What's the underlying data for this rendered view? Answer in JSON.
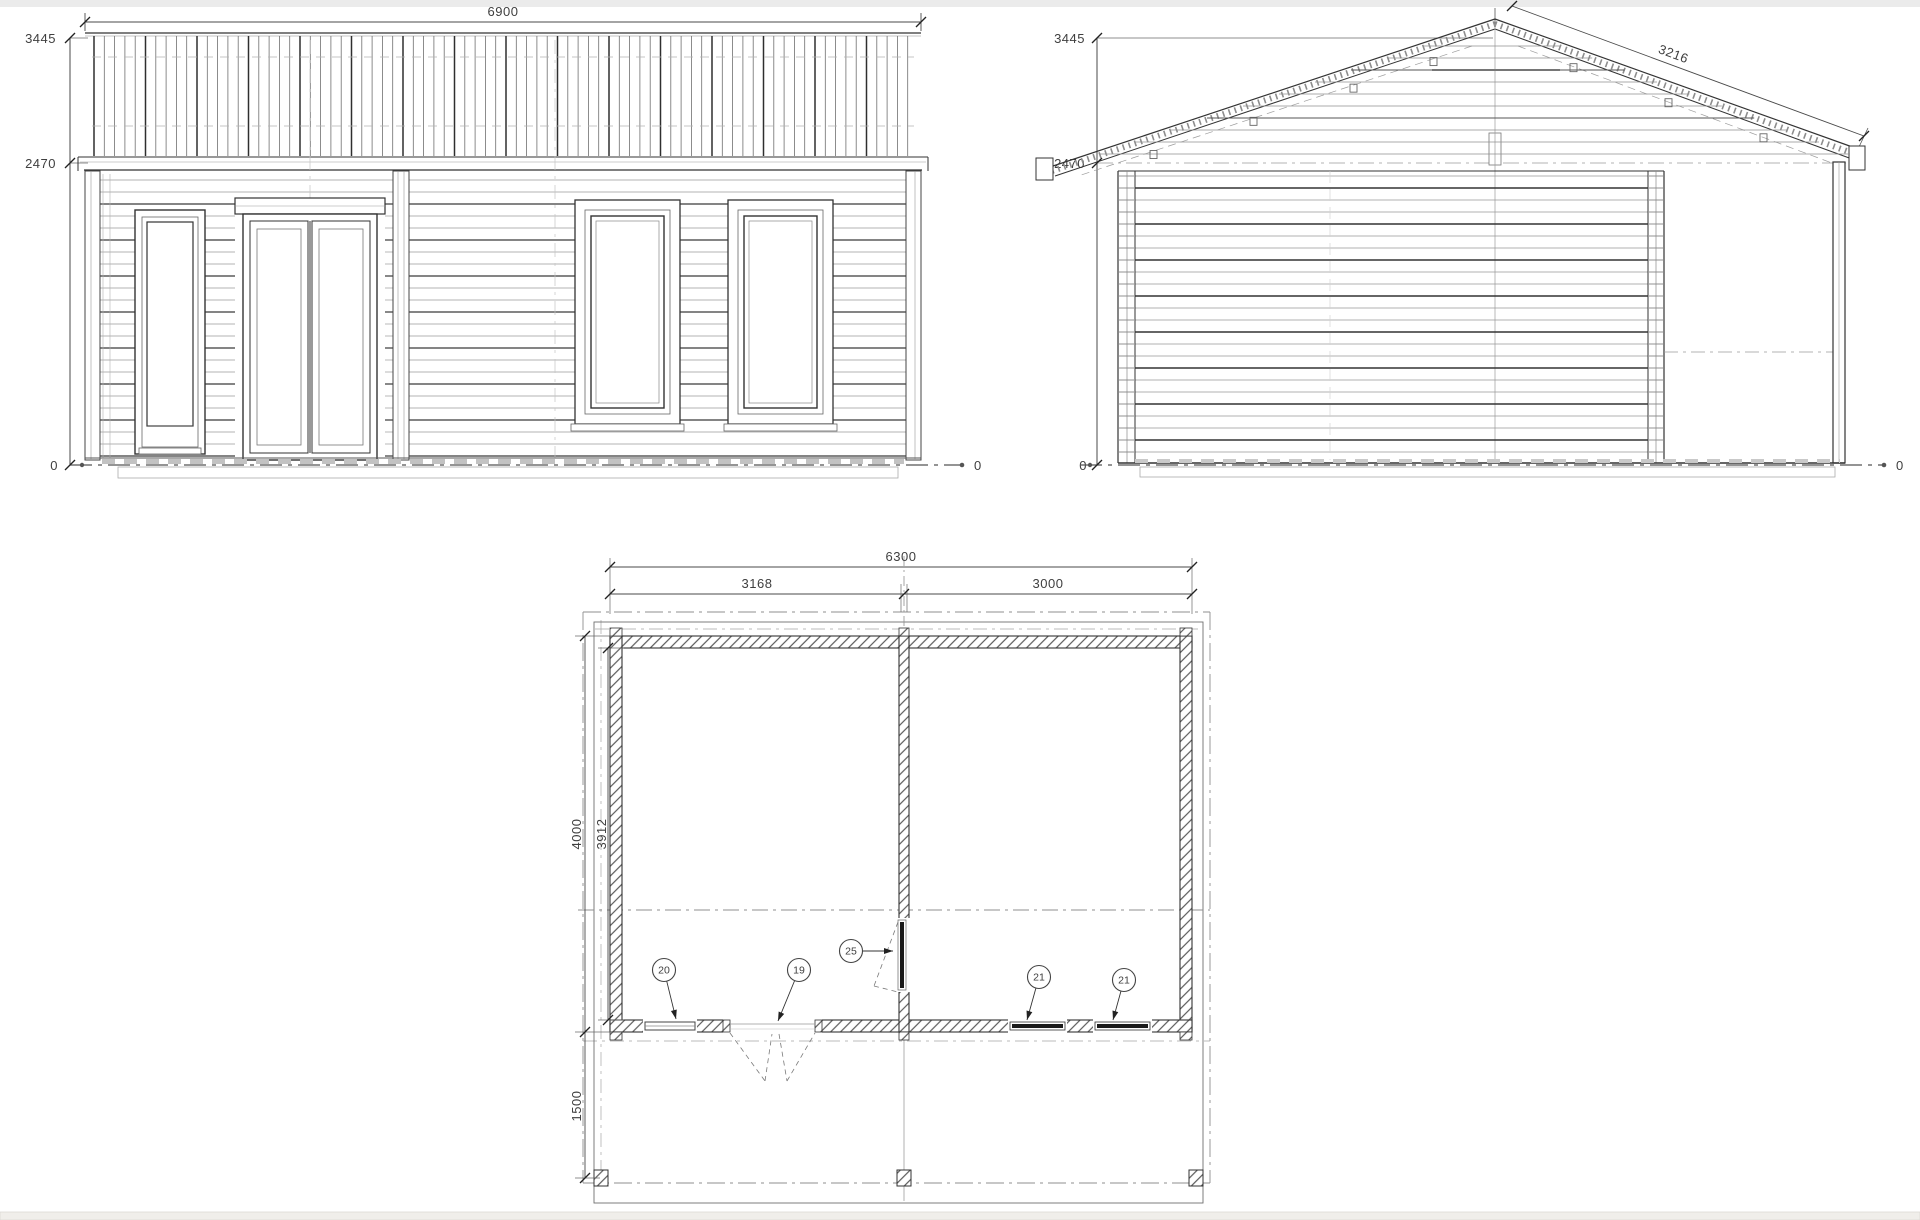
{
  "colors": {
    "paper": "#ffffff",
    "ink_dark": "#333333",
    "ink_mid": "#777777",
    "ink_light": "#aaaaaa",
    "top_strip": "#ebebeb",
    "bottom_strip": "#f0eeea"
  },
  "front_elevation": {
    "dim_width": "6900",
    "dim_ridge_height": "3445",
    "dim_eave_height": "2470",
    "dim_ground_left": "0",
    "dim_ground_right": "0"
  },
  "side_elevation": {
    "dim_ridge_height": "3445",
    "dim_eave_height": "2470",
    "dim_roof_slope": "3216",
    "dim_ground_left": "0",
    "dim_ground_right": "0"
  },
  "floor_plan": {
    "dim_total_width": "6300",
    "dim_left_room_width": "3168",
    "dim_right_room_width": "3000",
    "dim_overall_depth": "4000",
    "dim_interior_depth": "3912",
    "dim_terrace_depth": "1500",
    "callouts": [
      {
        "id": "20"
      },
      {
        "id": "19"
      },
      {
        "id": "25"
      },
      {
        "id": "21"
      },
      {
        "id": "21"
      }
    ]
  }
}
